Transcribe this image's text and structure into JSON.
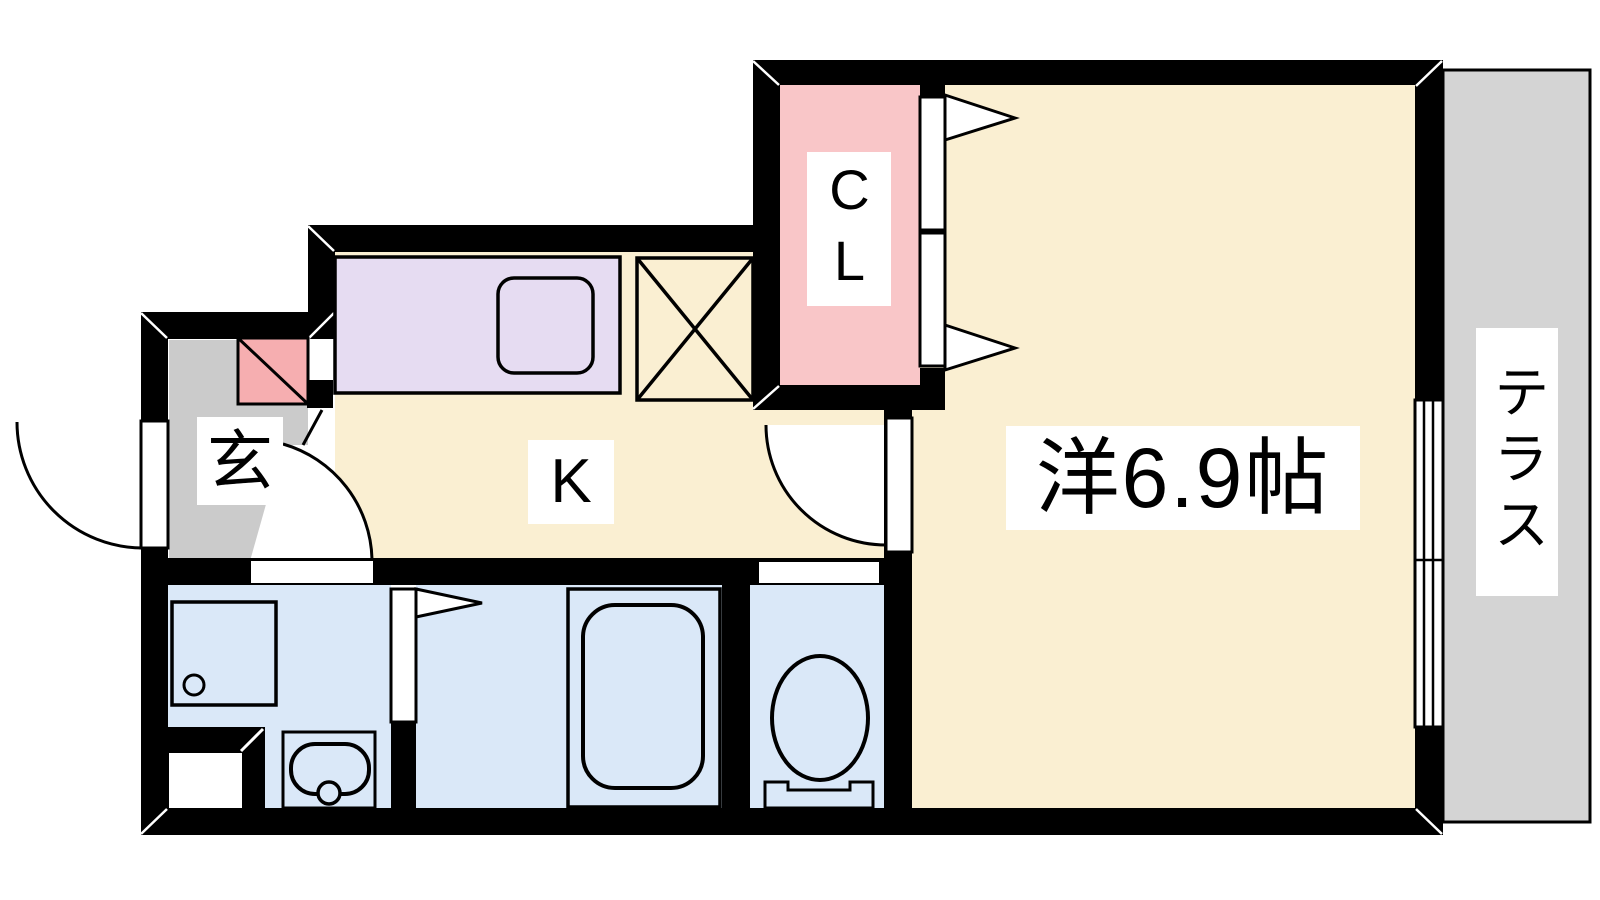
{
  "plan": {
    "type": "apartment-floor-plan",
    "rooms": {
      "western_room": {
        "label": "洋6.9帖",
        "size_tatami": "6.9"
      },
      "kitchen": {
        "label": "K"
      },
      "closet": {
        "label": "CL"
      },
      "entrance": {
        "label": "玄"
      },
      "terrace": {
        "label": "テラス"
      }
    },
    "fixtures": [
      "kitchen-counter-with-sink",
      "refrigerator-space",
      "shoe-cabinet",
      "washing-machine-pan",
      "washbasin",
      "bathtub",
      "toilet",
      "sliding-window",
      "closet-folding-doors",
      "entrance-door",
      "kitchen-room-door",
      "bathroom-folding-door"
    ]
  },
  "colors": {
    "wall": "#000000",
    "room_floor": "#FAEFD2",
    "wet_floor": "#DAE8F8",
    "closet_fill": "#F9C6C8",
    "shoebox_fill": "#F6AEB0",
    "counter_fill": "#E6DCF2",
    "hall_floor": "#CBCBCB",
    "terrace_floor": "#D4D4D4",
    "line": "#000000",
    "white": "#FFFFFF"
  }
}
